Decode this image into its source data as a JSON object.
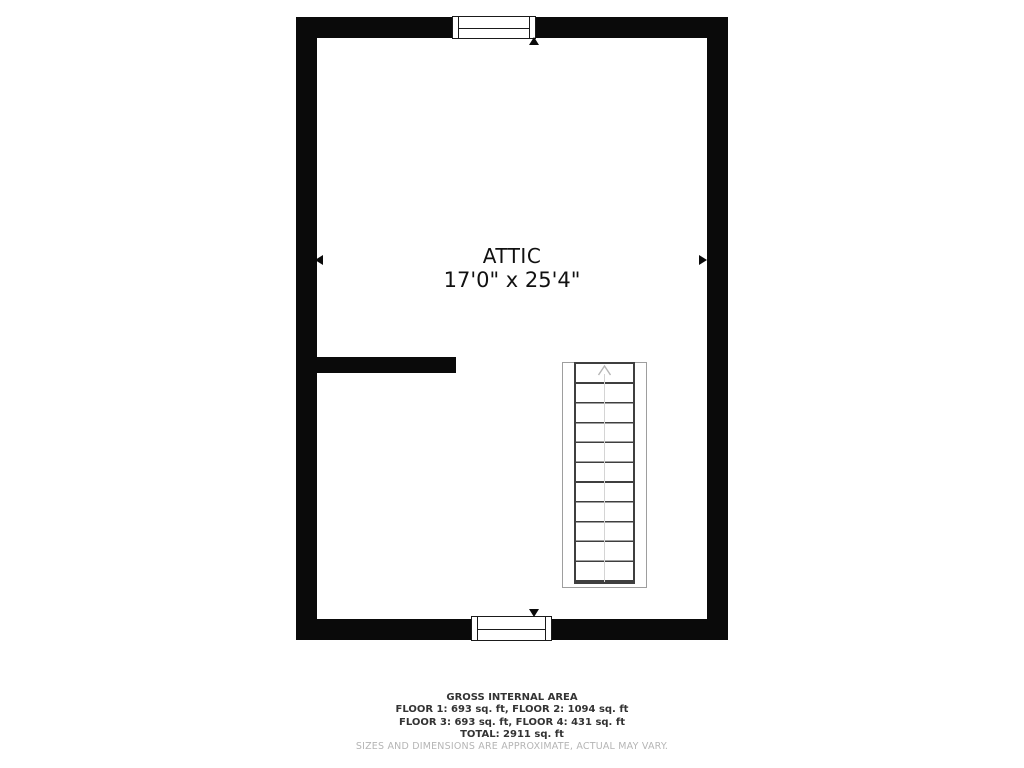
{
  "floorplan": {
    "room": {
      "name": "ATTIC",
      "dimensions": "17'0\" x 25'4\""
    },
    "features": {
      "windows": [
        "window-top",
        "window-bottom"
      ],
      "stairs": {
        "direction": "up",
        "treads": 11
      },
      "interior_wall": true
    },
    "colors": {
      "wall": "#0a0a0a",
      "label_text": "#111111",
      "stair_line": "#3f3f3f",
      "stair_enclosure": "#9e9e9e",
      "footer_text": "#333333",
      "disclaimer_text": "#b5b5b5",
      "background": "#ffffff"
    }
  },
  "footer": {
    "title": "GROSS INTERNAL AREA",
    "line1": "FLOOR 1: 693 sq. ft, FLOOR 2: 1094 sq. ft",
    "line2": "FLOOR 3: 693 sq. ft, FLOOR 4: 431 sq. ft",
    "total": "TOTAL: 2911 sq. ft",
    "disclaimer": "SIZES AND DIMENSIONS ARE APPROXIMATE, ACTUAL MAY VARY."
  }
}
